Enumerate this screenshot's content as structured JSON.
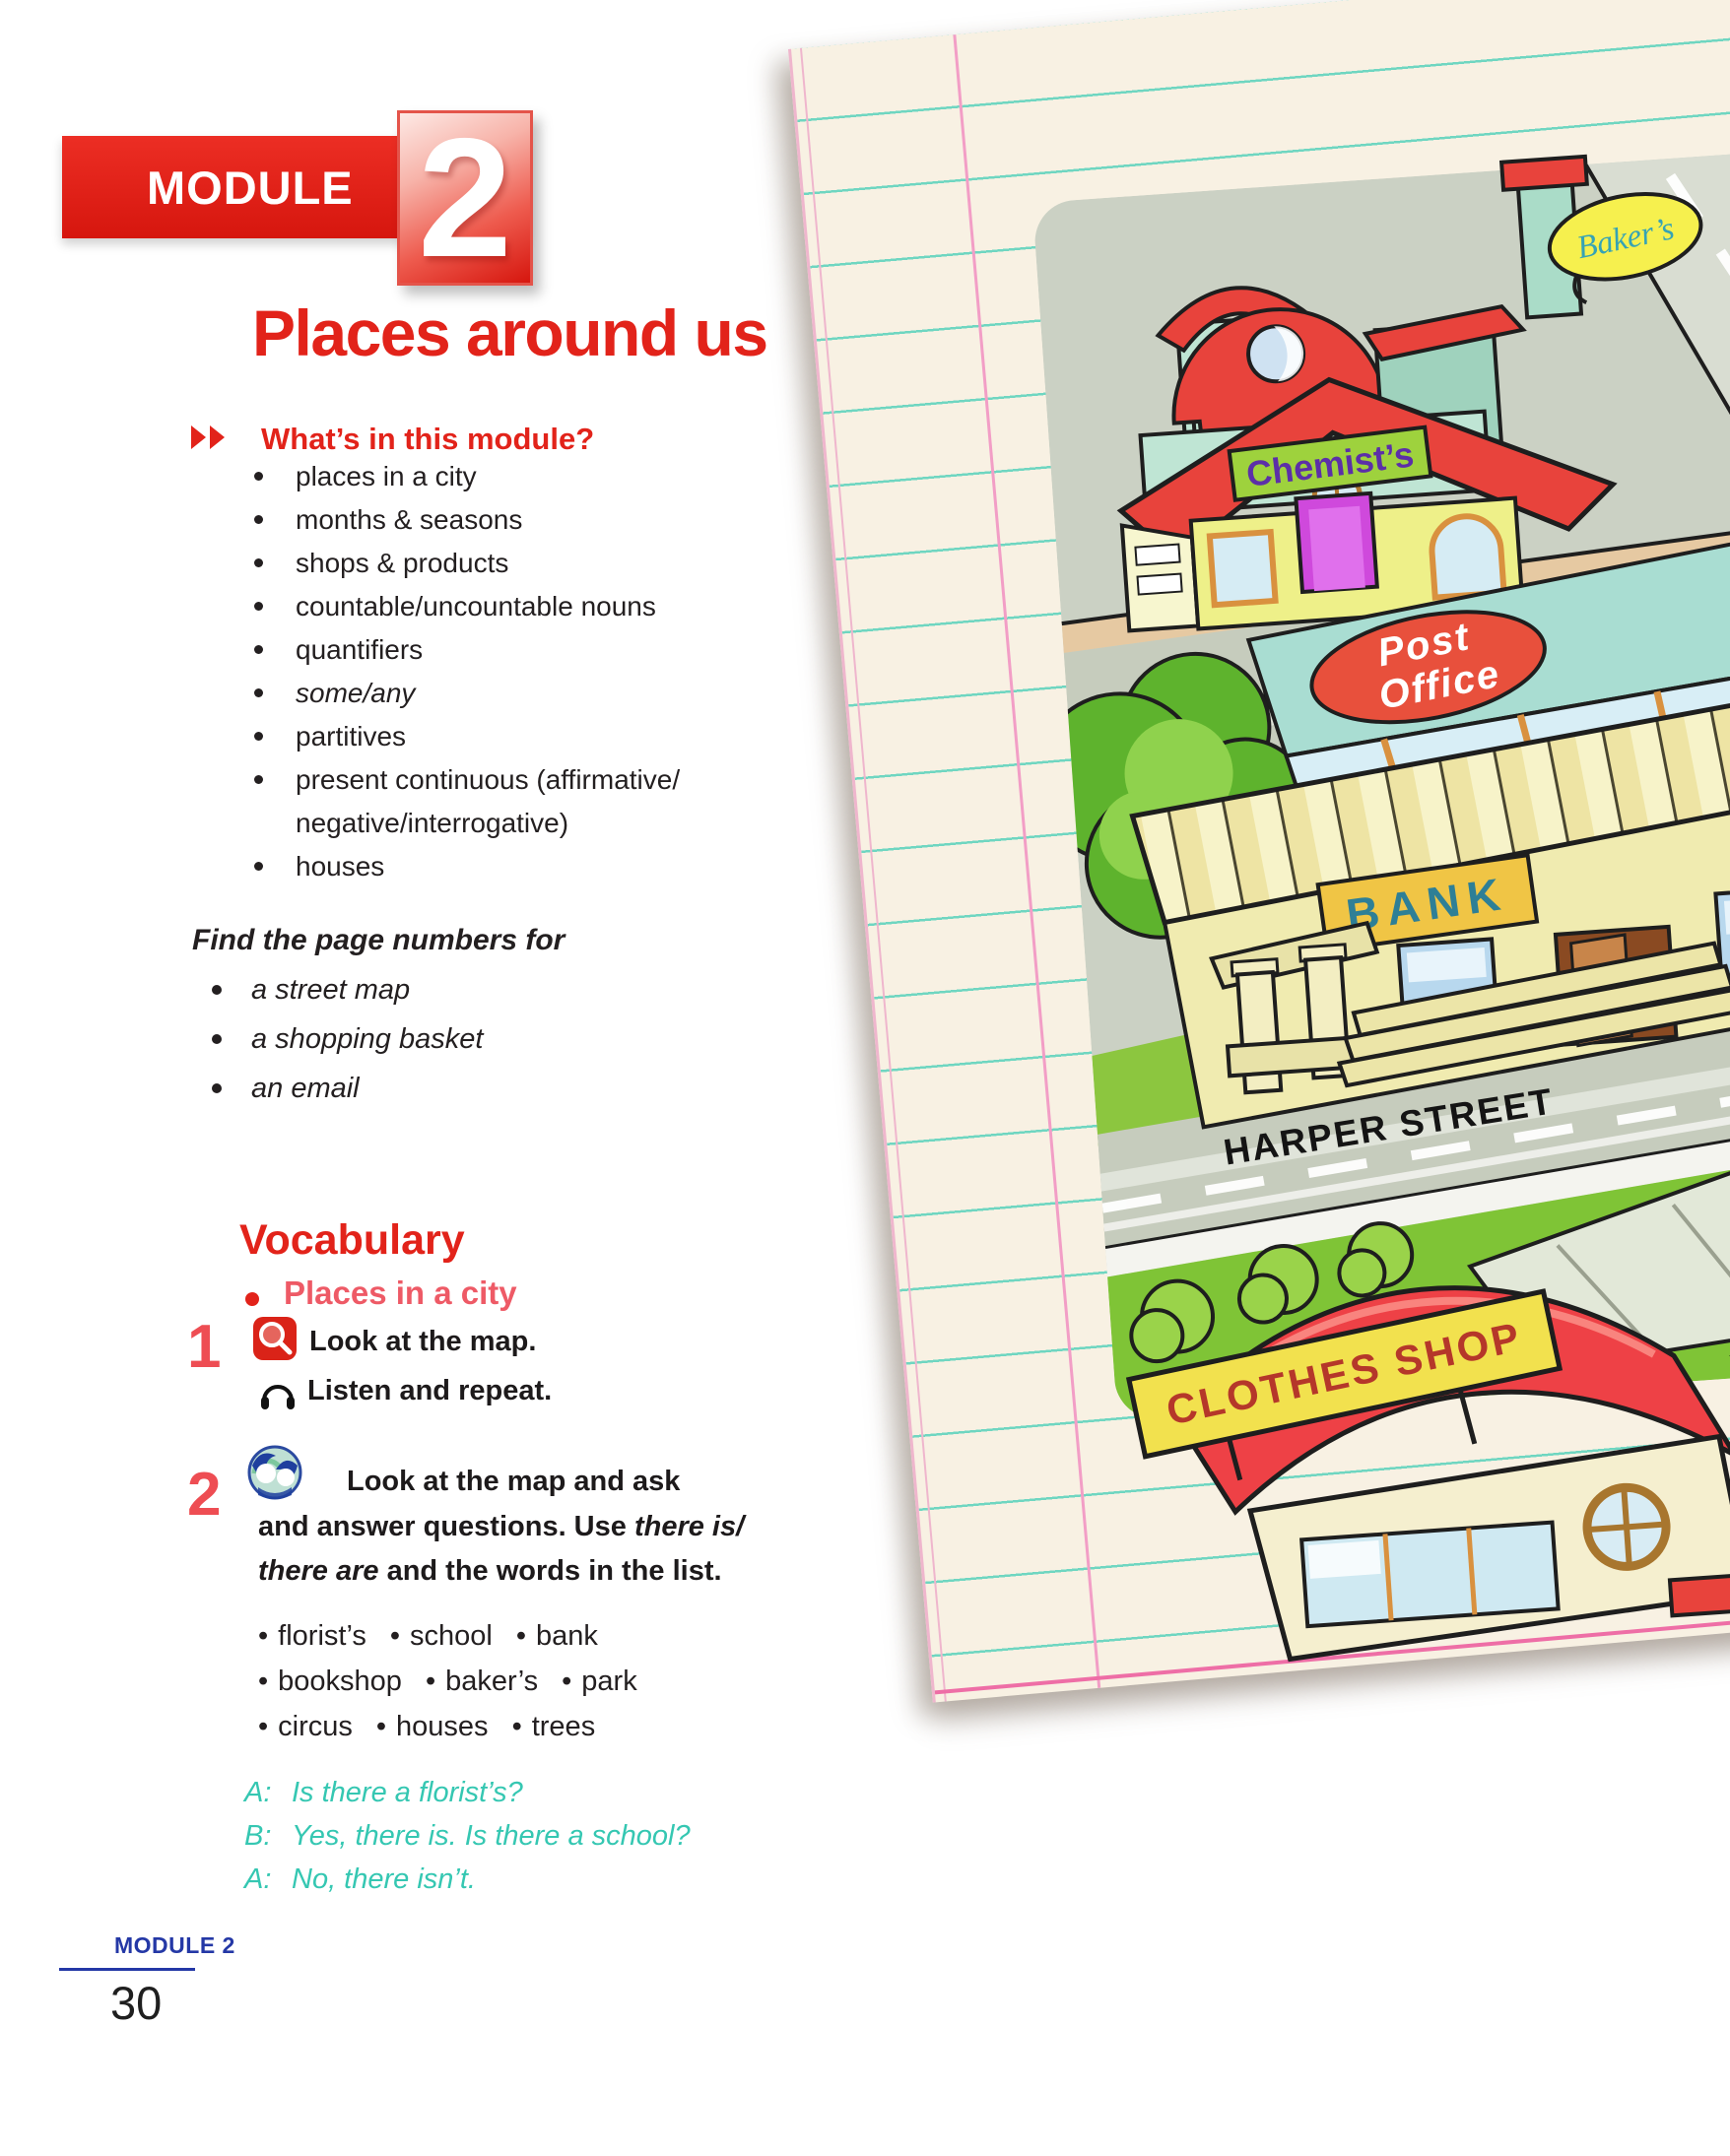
{
  "page": {
    "module_banner": {
      "label": "MODULE",
      "number": "2"
    },
    "title": "Places around us",
    "whats_in": {
      "heading": "What’s in this module?",
      "icon": "double-chevron-icon",
      "items": [
        {
          "text": "places in a city",
          "italic": false
        },
        {
          "text": "months & seasons",
          "italic": false
        },
        {
          "text": "shops & products",
          "italic": false
        },
        {
          "text": "countable/uncountable nouns",
          "italic": false
        },
        {
          "text": "quantifiers",
          "italic": false
        },
        {
          "text": "some/any",
          "italic": true
        },
        {
          "text": "partitives",
          "italic": false
        },
        {
          "text": "present continuous (affirmative/\nnegative/interrogative)",
          "italic": false
        },
        {
          "text": "houses",
          "italic": false
        }
      ]
    },
    "find_pages": {
      "heading": "Find the page numbers for",
      "items": [
        "a street map",
        "a shopping basket",
        "an email"
      ]
    },
    "vocabulary": {
      "heading": "Vocabulary",
      "subheading": "Places in a city"
    },
    "exercise1": {
      "number": "1",
      "look_icon": "magnifier-icon",
      "listen_icon": "headphones-icon",
      "line1": "Look at the map.",
      "line2": "Listen and repeat."
    },
    "exercise2": {
      "number": "2",
      "icon": "pairwork-icon",
      "line1": "Look at the map and ask",
      "line2_plain": "and answer questions. Use ",
      "line2_italic": "there is/",
      "line3_italic": "there are",
      "line3_plain": " and the words in the list."
    },
    "word_list": {
      "rows": [
        [
          "florist’s",
          "school",
          "bank"
        ],
        [
          "bookshop",
          "baker’s",
          "park"
        ],
        [
          "circus",
          "houses",
          "trees"
        ]
      ]
    },
    "dialogue": [
      {
        "label": "A:",
        "text": "Is there a florist’s?"
      },
      {
        "label": "B:",
        "text": "Yes, there is. Is there a school?"
      },
      {
        "label": "A:",
        "text": "No, there isn’t."
      }
    ],
    "footer": {
      "module": "MODULE 2",
      "page_number": "30"
    }
  },
  "map": {
    "signs": {
      "bakers": "Baker’s",
      "chemists": "Chemist’s",
      "milton": "MILTON STREET",
      "post_line1": "Post",
      "post_line2": "Office",
      "bank": "BANK",
      "harper": "HARPER STREET",
      "clothes": "CLOTHES SHOP"
    }
  },
  "colors": {
    "accent_red": "#e2231a",
    "salmon_subheading": "#ee5a66",
    "dialogue_teal": "#35c7b2",
    "footer_blue": "#2438a6",
    "paper_cream": "#f8f1e3",
    "paper_line_teal": "#6fd6c1",
    "paper_line_pink": "#f29ec6",
    "map_road_gray": "#c6ccbd",
    "lawn_green": "#7fc436",
    "roof_red": "#e8433c"
  }
}
